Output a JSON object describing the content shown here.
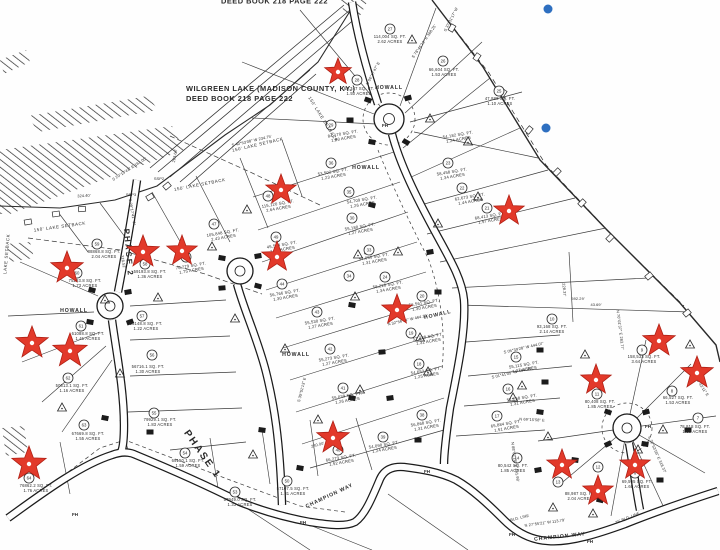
{
  "title": {
    "line1": "WILGREEN LAKE (MADISON COUNTY, KY.)",
    "line2": "DEED BOOK 218 PAGE 222",
    "clipped_top_text": "DEED BOOK 218 PAGE 222"
  },
  "colors": {
    "paper": "#fefefe",
    "ink": "#2a2a2a",
    "star": "#e2392a",
    "star_edge": "#b02015",
    "blue_dot": "#2e6fc0"
  },
  "road_labels": [
    {
      "t": "HOWALL",
      "x": 389,
      "y": 89,
      "r": 0
    },
    {
      "t": "HOWALL",
      "x": 366,
      "y": 169,
      "r": 0
    },
    {
      "t": "HOWALL",
      "x": 438,
      "y": 316,
      "r": -13
    },
    {
      "t": "HOWALL",
      "x": 74,
      "y": 312,
      "r": 0
    },
    {
      "t": "HOWALL",
      "x": 296,
      "y": 356,
      "r": 0
    },
    {
      "t": "CHAMPION WAY",
      "x": 560,
      "y": 538,
      "r": -6
    },
    {
      "t": "CHAMPION WAY",
      "x": 330,
      "y": 497,
      "r": -25
    }
  ],
  "phase_labels": [
    {
      "t": "PHASE 2",
      "x": 126,
      "y": 253,
      "r": 85,
      "s": 8
    },
    {
      "t": "PHASE 1",
      "x": 200,
      "y": 456,
      "r": 55,
      "s": 10
    }
  ],
  "setback_labels": [
    {
      "t": "150' LAKE SETBACK",
      "x": 258,
      "y": 146,
      "r": -13
    },
    {
      "t": "150' LAKE SETBACK",
      "x": 200,
      "y": 186,
      "r": -11
    },
    {
      "t": "150' LAKE SETBACK",
      "x": 60,
      "y": 228,
      "r": -8
    },
    {
      "t": "150' LAKE SETBACK",
      "x": 322,
      "y": 120,
      "r": 58
    },
    {
      "t": "LAKE SETBACK",
      "x": 8,
      "y": 254,
      "r": -85
    }
  ],
  "hydrants": [
    {
      "t": "FH",
      "x": 385,
      "y": 127
    },
    {
      "t": "FH",
      "x": 427,
      "y": 473
    },
    {
      "t": "FH",
      "x": 512,
      "y": 536
    },
    {
      "t": "FH",
      "x": 648,
      "y": 428
    },
    {
      "t": "FH",
      "x": 303,
      "y": 524
    },
    {
      "t": "FH",
      "x": 75,
      "y": 516
    },
    {
      "t": "FH",
      "x": 590,
      "y": 543
    }
  ],
  "survey_points": [
    {
      "t": "SSP2",
      "x": 159,
      "y": 180
    },
    {
      "t": "SSP3",
      "x": 131,
      "y": 196
    }
  ],
  "bearing_labels": [
    {
      "t": "S 78°46'10\" E  368.25'",
      "x": 425,
      "y": 42,
      "r": -55
    },
    {
      "t": "S 37°31'17\" W",
      "x": 452,
      "y": 20,
      "r": -63
    },
    {
      "t": "N 06°17'47\" E",
      "x": 374,
      "y": 74,
      "r": -62
    },
    {
      "t": "S 40°53'08\" W  234.75'",
      "x": 252,
      "y": 142,
      "r": -13
    },
    {
      "t": "324.40'",
      "x": 84,
      "y": 197,
      "r": -3
    },
    {
      "t": "S 29°13'41\" E  161.00'",
      "x": 130,
      "y": 170,
      "r": -33
    },
    {
      "t": "263.64'",
      "x": 176,
      "y": 156,
      "r": -80
    },
    {
      "t": "N 32°56'14\" W  464.15'",
      "x": 408,
      "y": 321,
      "r": -13
    },
    {
      "t": "S 35°51'13\" E",
      "x": 303,
      "y": 390,
      "r": -76
    },
    {
      "t": "S 05°39'28\" W  444.07'",
      "x": 524,
      "y": 349,
      "r": -13
    },
    {
      "t": "S 01°41'05\" W  454.93'",
      "x": 512,
      "y": 374,
      "r": -13
    },
    {
      "t": "592.29'",
      "x": 578,
      "y": 300,
      "r": 0
    },
    {
      "t": "N 70°01'37\" E  283.77'",
      "x": 619,
      "y": 330,
      "r": 83
    },
    {
      "t": "S 65°43'11\" E",
      "x": 700,
      "y": 386,
      "r": 57
    },
    {
      "t": "240.00'",
      "x": 318,
      "y": 446,
      "r": -15
    },
    {
      "t": "N 88°02'18\" E  441.98'",
      "x": 514,
      "y": 462,
      "r": 82
    },
    {
      "t": "N 27°55'21\" W  113.79'",
      "x": 545,
      "y": 524,
      "r": -8
    },
    {
      "t": "43.69'",
      "x": 596,
      "y": 306,
      "r": 0
    },
    {
      "t": "S 29°17'41\" W",
      "x": 131,
      "y": 212,
      "r": 80
    },
    {
      "t": "318.52'",
      "x": 122,
      "y": 262,
      "r": 80
    },
    {
      "t": "N 69°15'58\" E",
      "x": 532,
      "y": 421,
      "r": 3
    },
    {
      "t": "BLD. LINE",
      "x": 520,
      "y": 519,
      "r": -14
    },
    {
      "t": "25' BLD. LINE",
      "x": 628,
      "y": 519,
      "r": -22
    },
    {
      "t": "S 72°53'56\" E  318.37'",
      "x": 656,
      "y": 455,
      "r": 66
    },
    {
      "t": "228.37'",
      "x": 563,
      "y": 290,
      "r": 85
    }
  ],
  "lots": [
    {
      "n": "27",
      "sqft": "114,004 SQ. FT.",
      "acres": "2.62 ACRES",
      "cx": 390,
      "cy": 29,
      "lx": 390,
      "ly": 38,
      "r": 0
    },
    {
      "n": "26",
      "sqft": "66,604 SQ. FT.",
      "acres": "1.53 ACRES",
      "cx": 443,
      "cy": 61,
      "lx": 444,
      "ly": 71,
      "r": 0
    },
    {
      "n": "25",
      "sqft": "47,888 SQ. FT.",
      "acres": "1.10 ACRES",
      "cx": 499,
      "cy": 91,
      "lx": 500,
      "ly": 100,
      "r": 0
    },
    {
      "n": "28",
      "sqft": "65,347 SQ. FT.",
      "acres": "1.50 ACRES",
      "cx": 357,
      "cy": 80,
      "lx": 359,
      "ly": 90,
      "r": 0
    },
    {
      "n": "29",
      "sqft": "84,170 SQ. FT.",
      "acres": "1.93 ACRES",
      "cx": 331,
      "cy": 125,
      "lx": 343,
      "ly": 135,
      "r": -10
    },
    {
      "n": "",
      "sqft": "54,182 SQ. FT.",
      "acres": "1.24 ACRES",
      "cx": 0,
      "cy": 0,
      "lx": 458,
      "ly": 136,
      "r": -10
    },
    {
      "n": "36",
      "sqft": "53,502 SQ. FT.",
      "acres": "1.23 ACRES",
      "cx": 331,
      "cy": 163,
      "lx": 333,
      "ly": 173,
      "r": -10
    },
    {
      "n": "23",
      "sqft": "58,458 SQ. FT.",
      "acres": "1.34 ACRES",
      "cx": 448,
      "cy": 163,
      "lx": 452,
      "ly": 173,
      "r": -10
    },
    {
      "n": "35",
      "sqft": "54,709 SQ. FT.",
      "acres": "1.26 ACRES",
      "cx": 349,
      "cy": 192,
      "lx": 362,
      "ly": 201,
      "r": -10
    },
    {
      "n": "22",
      "sqft": "62,673 SQ. FT.",
      "acres": "1.44 ACRES",
      "cx": 462,
      "cy": 188,
      "lx": 470,
      "ly": 198,
      "r": -10
    },
    {
      "n": "21",
      "sqft": "68,413 SQ. FT.",
      "acres": "1.57 ACRES",
      "cx": 487,
      "cy": 208,
      "lx": 490,
      "ly": 217,
      "r": -10
    },
    {
      "n": "30",
      "sqft": "55,180 SQ. FT.",
      "acres": "1.27 ACRES",
      "cx": 352,
      "cy": 218,
      "lx": 360,
      "ly": 228,
      "r": -10
    },
    {
      "n": "33",
      "sqft": "57,056 SQ. FT.",
      "acres": "1.31 ACRES",
      "cx": 369,
      "cy": 250,
      "lx": 374,
      "ly": 258,
      "r": -10
    },
    {
      "n": "34",
      "sqft": "",
      "acres": "",
      "cx": 349,
      "cy": 276,
      "lx": 349,
      "ly": 276,
      "r": 0
    },
    {
      "n": "24",
      "sqft": "58,228 SQ. FT.",
      "acres": "1.34 ACRES",
      "cx": 385,
      "cy": 277,
      "lx": 388,
      "ly": 286,
      "r": -10
    },
    {
      "n": "20",
      "sqft": "56,561 SQ. FT.",
      "acres": "1.30 ACRES",
      "cx": 422,
      "cy": 296,
      "lx": 424,
      "ly": 304,
      "r": -10
    },
    {
      "n": "19",
      "sqft": "57,288 SQ. FT.",
      "acres": "1.32 ACRES",
      "cx": 411,
      "cy": 333,
      "lx": 428,
      "ly": 338,
      "r": -10
    },
    {
      "n": "18",
      "sqft": "54,652 SQ. FT.",
      "acres": "1.25 ACRES",
      "cx": 419,
      "cy": 364,
      "lx": 426,
      "ly": 372,
      "r": -10
    },
    {
      "n": "43",
      "sqft": "55,530 SQ. FT.",
      "acres": "1.27 ACRES",
      "cx": 317,
      "cy": 312,
      "lx": 320,
      "ly": 322,
      "r": -10
    },
    {
      "n": "42",
      "sqft": "55,273 SQ. FT.",
      "acres": "1.27 ACRES",
      "cx": 330,
      "cy": 349,
      "lx": 334,
      "ly": 359,
      "r": -10
    },
    {
      "n": "41",
      "sqft": "55,039 SQ. FT.",
      "acres": "1.26 ACRES",
      "cx": 343,
      "cy": 388,
      "lx": 347,
      "ly": 397,
      "r": -10
    },
    {
      "n": "44",
      "sqft": "56,766 SQ. FT.",
      "acres": "1.30 ACRES",
      "cx": 282,
      "cy": 284,
      "lx": 285,
      "ly": 294,
      "r": -10
    },
    {
      "n": "40",
      "sqft": "66,273 SQ. FT.",
      "acres": "1.52 ACRES",
      "cx": 338,
      "cy": 450,
      "lx": 341,
      "ly": 459,
      "r": -10
    },
    {
      "n": "39",
      "sqft": "54,090 SQ. FT.",
      "acres": "1.24 ACRES",
      "cx": 383,
      "cy": 437,
      "lx": 384,
      "ly": 446,
      "r": -10
    },
    {
      "n": "38",
      "sqft": "56,868 SQ. FT.",
      "acres": "1.31 ACRES",
      "cx": 422,
      "cy": 415,
      "lx": 426,
      "ly": 424,
      "r": -10
    },
    {
      "n": "50",
      "sqft": "57107.5 SQ. FT.",
      "acres": "1.31 ACRES",
      "cx": 287,
      "cy": 481,
      "lx": 293,
      "ly": 490,
      "r": 0
    },
    {
      "n": "53",
      "sqft": "57949.0 SQ. FT.",
      "acres": "1.33 ACRES",
      "cx": 235,
      "cy": 492,
      "lx": 240,
      "ly": 501,
      "r": 0
    },
    {
      "n": "64",
      "sqft": "76862.2 SQ. FT.",
      "acres": "1.76 ACRES",
      "cx": 29,
      "cy": 478,
      "lx": 36,
      "ly": 487,
      "r": 0
    },
    {
      "n": "63",
      "sqft": "67669.8 SQ. FT.",
      "acres": "1.55 ACRES",
      "cx": 84,
      "cy": 425,
      "lx": 88,
      "ly": 435,
      "r": 0
    },
    {
      "n": "55",
      "sqft": "79929.1 SQ. FT.",
      "acres": "1.83 ACRES",
      "cx": 154,
      "cy": 413,
      "lx": 160,
      "ly": 421,
      "r": 0
    },
    {
      "n": "54",
      "sqft": "69150.1 SQ. FT.",
      "acres": "1.59 ACRES",
      "cx": 185,
      "cy": 453,
      "lx": 188,
      "ly": 462,
      "r": 0
    },
    {
      "n": "59",
      "sqft": "88868.8 SQ. FT.",
      "acres": "2.04 ACRES",
      "cx": 97,
      "cy": 244,
      "lx": 104,
      "ly": 253,
      "r": 0
    },
    {
      "n": "60",
      "sqft": "75293.8 SQ. FT.",
      "acres": "1.73 ACRES",
      "cx": 77,
      "cy": 273,
      "lx": 85,
      "ly": 282,
      "r": 0
    },
    {
      "n": "61",
      "sqft": "61088.8 SQ. FT.",
      "acres": "1.41 ACRES",
      "cx": 81,
      "cy": 326,
      "lx": 88,
      "ly": 335,
      "r": 0
    },
    {
      "n": "57",
      "sqft": "53148.8 SQ. FT.",
      "acres": "1.22 ACRES",
      "cx": 142,
      "cy": 316,
      "lx": 146,
      "ly": 325,
      "r": 0
    },
    {
      "n": "56",
      "sqft": "56716.1 SQ. FT.",
      "acres": "1.30 ACRES",
      "cx": 152,
      "cy": 355,
      "lx": 148,
      "ly": 368,
      "r": 0
    },
    {
      "n": "62",
      "sqft": "50613.1 SQ. FT.",
      "acres": "1.16 ACRES",
      "cx": 68,
      "cy": 378,
      "lx": 72,
      "ly": 387,
      "r": 0
    },
    {
      "n": "58",
      "sqft": "59193.8 SQ. FT.",
      "acres": "1.36 ACRES",
      "cx": 145,
      "cy": 264,
      "lx": 150,
      "ly": 273,
      "r": 0
    },
    {
      "n": "48",
      "sqft": "115,120 SQ. FT.",
      "acres": "2.64 ACRES",
      "cx": 268,
      "cy": 196,
      "lx": 278,
      "ly": 205,
      "r": -10
    },
    {
      "n": "47",
      "sqft": "105,848 SQ. FT.",
      "acres": "2.43 ACRES",
      "cx": 214,
      "cy": 224,
      "lx": 223,
      "ly": 234,
      "r": -10
    },
    {
      "n": "46",
      "sqft": "76,279 SQ. FT.",
      "acres": "1.75 ACRES",
      "cx": 186,
      "cy": 257,
      "lx": 191,
      "ly": 267,
      "r": -10
    },
    {
      "n": "49",
      "sqft": "45,534 SQ. FT.",
      "acres": "1.05 ACRES",
      "cx": 276,
      "cy": 237,
      "lx": 282,
      "ly": 246,
      "r": -10
    },
    {
      "n": "9",
      "sqft": "158,533 SQ. FT.",
      "acres": "3.64 ACRES",
      "cx": 642,
      "cy": 350,
      "lx": 644,
      "ly": 358,
      "r": 0
    },
    {
      "n": "11",
      "sqft": "80,408 SQ. FT.",
      "acres": "1.85 ACRES",
      "cx": 597,
      "cy": 394,
      "lx": 600,
      "ly": 403,
      "r": 0
    },
    {
      "n": "8",
      "sqft": "66,527 SQ. FT.",
      "acres": "1.53 ACRES",
      "cx": 672,
      "cy": 391,
      "lx": 678,
      "ly": 399,
      "r": 0
    },
    {
      "n": "7",
      "sqft": "78,818 SQ. FT.",
      "acres": "1.80 ACRES",
      "cx": 698,
      "cy": 418,
      "lx": 695,
      "ly": 428,
      "r": 0
    },
    {
      "n": "10",
      "sqft": "93,168 SQ. FT.",
      "acres": "2.14 ACRES",
      "cx": 552,
      "cy": 319,
      "lx": 552,
      "ly": 328,
      "r": 0
    },
    {
      "n": "13",
      "sqft": "88,987 SQ. FT.",
      "acres": "2.04 ACRES",
      "cx": 558,
      "cy": 482,
      "lx": 580,
      "ly": 495,
      "r": 0
    },
    {
      "n": "12",
      "sqft": "",
      "acres": "",
      "cx": 598,
      "cy": 467,
      "lx": 598,
      "ly": 467,
      "r": 0
    },
    {
      "n": "6",
      "sqft": "69,505 SQ. FT.",
      "acres": "1.60 ACRES",
      "cx": 635,
      "cy": 473,
      "lx": 637,
      "ly": 483,
      "r": 0
    },
    {
      "n": "14",
      "sqft": "80,542 SQ. FT.",
      "acres": "1.85 ACRES",
      "cx": 517,
      "cy": 458,
      "lx": 513,
      "ly": 467,
      "r": 0
    },
    {
      "n": "15",
      "sqft": "55,115 SQ. FT.",
      "acres": "1.27 ACRES",
      "cx": 516,
      "cy": 357,
      "lx": 524,
      "ly": 366,
      "r": -10
    },
    {
      "n": "16",
      "sqft": "57,258 SQ. FT.",
      "acres": "1.31 ACRES",
      "cx": 508,
      "cy": 389,
      "lx": 522,
      "ly": 399,
      "r": -10
    },
    {
      "n": "17",
      "sqft": "65,884 SQ. FT.",
      "acres": "1.51 ACRES",
      "cx": 497,
      "cy": 416,
      "lx": 506,
      "ly": 425,
      "r": -10
    }
  ],
  "stars": [
    [
      338,
      72,
      14
    ],
    [
      281,
      190,
      16
    ],
    [
      143,
      252,
      17
    ],
    [
      182,
      251,
      16
    ],
    [
      277,
      257,
      16
    ],
    [
      67,
      268,
      17
    ],
    [
      509,
      211,
      16
    ],
    [
      32,
      343,
      17
    ],
    [
      70,
      351,
      18
    ],
    [
      397,
      310,
      16
    ],
    [
      659,
      341,
      17
    ],
    [
      596,
      380,
      16
    ],
    [
      697,
      373,
      17
    ],
    [
      333,
      438,
      17
    ],
    [
      29,
      464,
      18
    ],
    [
      562,
      465,
      16
    ],
    [
      635,
      465,
      16
    ],
    [
      598,
      491,
      16
    ]
  ],
  "blue_dots": [
    [
      548,
      9,
      4.5
    ],
    [
      546,
      128,
      4.5
    ]
  ]
}
